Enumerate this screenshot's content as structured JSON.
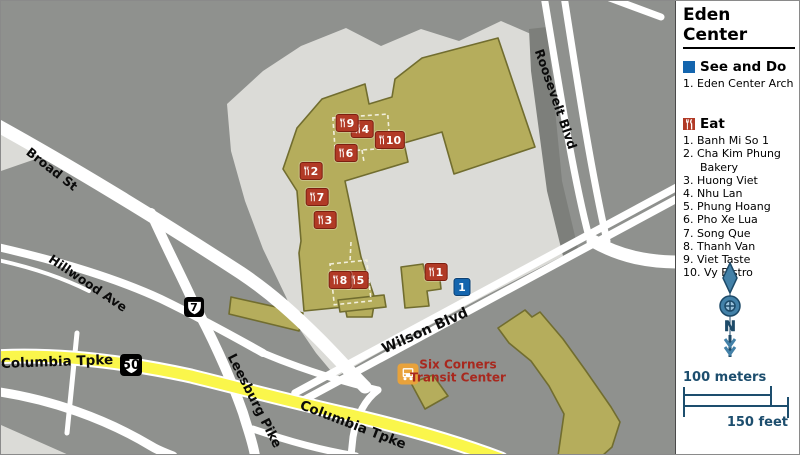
{
  "legend": {
    "title": "Eden Center",
    "see_and_do": {
      "heading": "See and Do",
      "items": [
        {
          "num": "1.",
          "label": "Eden Center Arch"
        }
      ]
    },
    "eat": {
      "heading": "Eat",
      "items": [
        {
          "num": "1.",
          "label": "Banh Mi So 1"
        },
        {
          "num": "2.",
          "label": "Cha Kim Phung Bakery"
        },
        {
          "num": "3.",
          "label": "Huong Viet"
        },
        {
          "num": "4.",
          "label": "Nhu Lan"
        },
        {
          "num": "5.",
          "label": "Phung Hoang"
        },
        {
          "num": "6.",
          "label": "Pho Xe Lua"
        },
        {
          "num": "7.",
          "label": "Song Que"
        },
        {
          "num": "8.",
          "label": "Thanh Van"
        },
        {
          "num": "9.",
          "label": "Viet Taste"
        },
        {
          "num": "10.",
          "label": "Vy Bistro"
        }
      ]
    },
    "compass_label": "N",
    "scale": {
      "meters": "100 meters",
      "feet": "150 feet"
    }
  },
  "map": {
    "road_labels": [
      {
        "id": "broad-st",
        "text": "Broad St",
        "x": 51,
        "y": 168,
        "rot": 38
      },
      {
        "id": "hillwood-ave",
        "text": "Hillwood Ave",
        "x": 87,
        "y": 282,
        "rot": 34
      },
      {
        "id": "roosevelt-blvd",
        "text": "Roosevelt Blvd",
        "x": 555,
        "y": 98,
        "rot": 71
      },
      {
        "id": "wilson-blvd",
        "text": "Wilson Blvd",
        "x": 424,
        "y": 330,
        "rot": -24,
        "size": 14
      },
      {
        "id": "columbia-tpke-w",
        "text": "Columbia Tpke",
        "x": 56,
        "y": 361,
        "rot": -2,
        "size": 13.5
      },
      {
        "id": "columbia-tpke-e",
        "text": "Columbia Tpke",
        "x": 352,
        "y": 424,
        "rot": 21,
        "size": 13.5
      },
      {
        "id": "leesburg-pike",
        "text": "Leesburg Pike",
        "x": 253,
        "y": 400,
        "rot": 63,
        "size": 13
      }
    ],
    "shields": [
      {
        "id": "route-7",
        "label": "7",
        "x": 193,
        "y": 306,
        "size": 20
      },
      {
        "id": "route-50",
        "label": "50",
        "x": 130,
        "y": 364,
        "size": 22
      }
    ],
    "transit": {
      "line1": "Six Corners",
      "line2": "Transit Center",
      "x": 457,
      "y": 370,
      "bus_x": 407,
      "bus_y": 373
    },
    "markers": {
      "eat": [
        {
          "n": "1",
          "x": 435,
          "y": 271
        },
        {
          "n": "2",
          "x": 310,
          "y": 170
        },
        {
          "n": "3",
          "x": 324,
          "y": 219
        },
        {
          "n": "4",
          "x": 361,
          "y": 128
        },
        {
          "n": "5",
          "x": 356,
          "y": 279
        },
        {
          "n": "6",
          "x": 345,
          "y": 152
        },
        {
          "n": "7",
          "x": 316,
          "y": 196
        },
        {
          "n": "8",
          "x": 339,
          "y": 279
        },
        {
          "n": "9",
          "x": 346,
          "y": 122
        },
        {
          "n": "10",
          "x": 389,
          "y": 139
        }
      ],
      "see": [
        {
          "n": "1",
          "x": 461,
          "y": 286
        }
      ]
    },
    "colors": {
      "background": "#8F918E",
      "parking": "#DBDBD7",
      "building": "#B5AD5C",
      "building_outline": "#716D2F",
      "road": "#FFFFFF",
      "highlight_road": "#FAF64B",
      "eat_marker": "#B13A26",
      "see_marker": "#1465AE",
      "transit_text": "#A8281E",
      "bus_icon": "#E8A23B",
      "compass": "#4381A8",
      "scale_ink": "#1D4E6E"
    }
  }
}
